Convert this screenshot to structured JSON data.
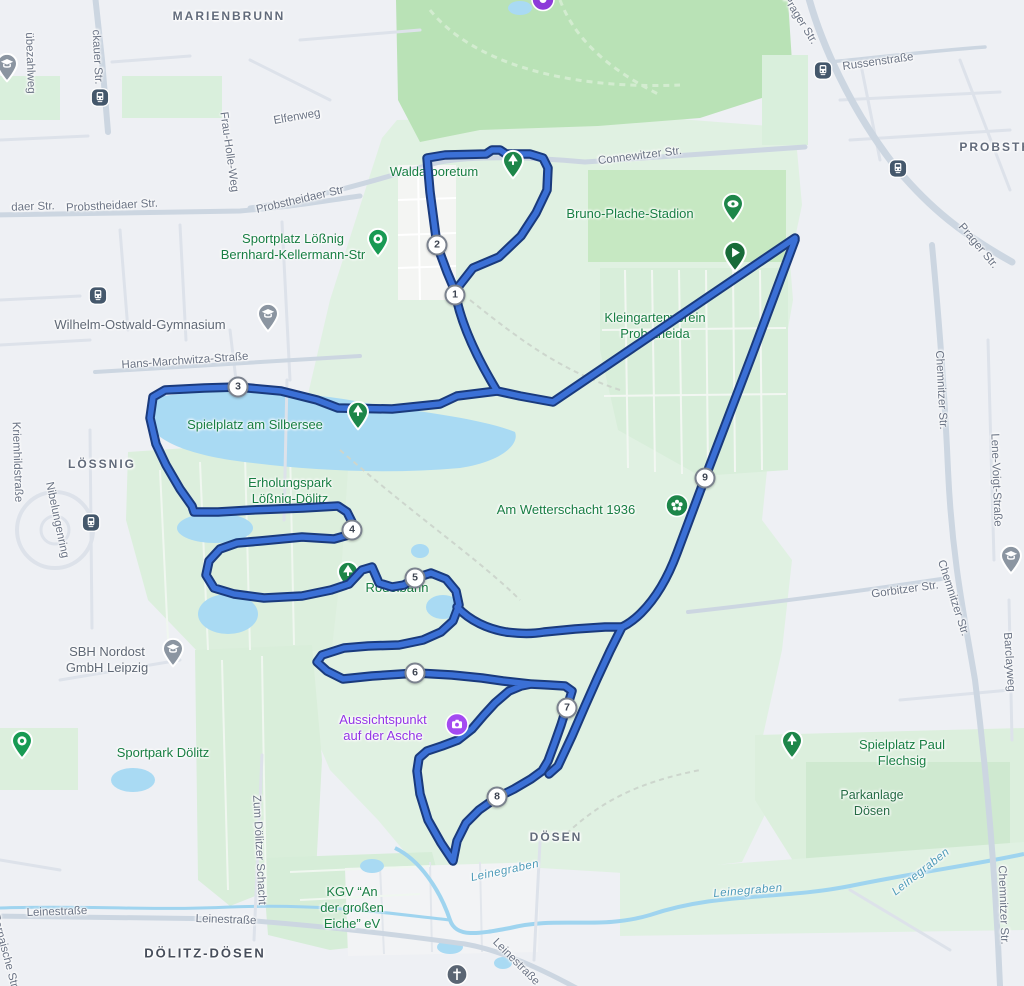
{
  "map": {
    "route": {
      "fill_color": "#3b70d6",
      "outline_color": "#1a3a7c",
      "start_color": "#186b38",
      "km_markers": [
        {
          "label": "1",
          "x": 455,
          "y": 295
        },
        {
          "label": "2",
          "x": 437,
          "y": 245
        },
        {
          "label": "3",
          "x": 238,
          "y": 387
        },
        {
          "label": "4",
          "x": 352,
          "y": 530
        },
        {
          "label": "5",
          "x": 415,
          "y": 578
        },
        {
          "label": "6",
          "x": 415,
          "y": 673
        },
        {
          "label": "7",
          "x": 567,
          "y": 708
        },
        {
          "label": "8",
          "x": 497,
          "y": 797
        },
        {
          "label": "9",
          "x": 705,
          "y": 478
        }
      ],
      "start_marker": {
        "x": 735,
        "y": 276
      }
    },
    "area_labels": [
      {
        "text": "MARIENBRUNN",
        "x": 229,
        "y": 16,
        "rot": 0,
        "cls": "area"
      },
      {
        "text": "PROBSTHEIDA",
        "x": 1014,
        "y": 147,
        "rot": 0,
        "cls": "area"
      },
      {
        "text": "LÖSSNIG",
        "x": 102,
        "y": 464,
        "rot": 0,
        "cls": "area"
      },
      {
        "text": "DÖSEN",
        "x": 556,
        "y": 837,
        "rot": 0,
        "cls": "area"
      },
      {
        "text": "DÖLITZ-DÖSEN",
        "x": 205,
        "y": 953,
        "rot": 0,
        "cls": "area-dark"
      }
    ],
    "street_labels": [
      {
        "text": "übezahlweg",
        "x": 30,
        "y": 63,
        "rot": 88
      },
      {
        "text": "ckauer Str.",
        "x": 97,
        "y": 57,
        "rot": 87
      },
      {
        "text": "Frau-Holle-Weg",
        "x": 229,
        "y": 152,
        "rot": 82
      },
      {
        "text": "Elfenweg",
        "x": 297,
        "y": 117,
        "rot": -10
      },
      {
        "text": "daer Str.",
        "x": 33,
        "y": 207,
        "rot": -2
      },
      {
        "text": "Probstheidaer Str.",
        "x": 112,
        "y": 206,
        "rot": -3
      },
      {
        "text": "Probstheidaer Str",
        "x": 300,
        "y": 200,
        "rot": -13
      },
      {
        "text": "Connewitzer Str.",
        "x": 640,
        "y": 156,
        "rot": -7
      },
      {
        "text": "Prager Str.",
        "x": 800,
        "y": 20,
        "rot": 58
      },
      {
        "text": "Russenstraße",
        "x": 878,
        "y": 62,
        "rot": -8
      },
      {
        "text": "Prager Str.",
        "x": 978,
        "y": 246,
        "rot": 50
      },
      {
        "text": "Chemnitzer Str.",
        "x": 941,
        "y": 390,
        "rot": 87
      },
      {
        "text": "Lene-Voigt-Straße",
        "x": 996,
        "y": 480,
        "rot": 88
      },
      {
        "text": "Chemnitzer Str.",
        "x": 953,
        "y": 598,
        "rot": 72
      },
      {
        "text": "Gorbitzer Str.",
        "x": 905,
        "y": 590,
        "rot": -8
      },
      {
        "text": "Barclayweg",
        "x": 1009,
        "y": 662,
        "rot": 86
      },
      {
        "text": "Hans-Marchwitza-Straße",
        "x": 185,
        "y": 361,
        "rot": -4
      },
      {
        "text": "Kriemhildstraße",
        "x": 17,
        "y": 462,
        "rot": 88
      },
      {
        "text": "Nibelungenring",
        "x": 57,
        "y": 520,
        "rot": 78
      },
      {
        "text": "Zum Dölitzer Schacht",
        "x": 259,
        "y": 850,
        "rot": 87
      },
      {
        "text": "Leinestraße",
        "x": 57,
        "y": 912,
        "rot": -2
      },
      {
        "text": "Leinestraße",
        "x": 226,
        "y": 920,
        "rot": 2
      },
      {
        "text": "Leinestraße",
        "x": 516,
        "y": 962,
        "rot": 45
      },
      {
        "text": "Bornaische Str.",
        "x": 5,
        "y": 952,
        "rot": 75
      },
      {
        "text": "Chemnitzer Str.",
        "x": 1003,
        "y": 905,
        "rot": 88
      }
    ],
    "water_labels": [
      {
        "text": "Leinegraben",
        "x": 505,
        "y": 871,
        "rot": -12
      },
      {
        "text": "Leinegraben",
        "x": 748,
        "y": 891,
        "rot": -5
      },
      {
        "text": "Leinegraben",
        "x": 921,
        "y": 872,
        "rot": -38
      }
    ],
    "poi_labels": [
      {
        "lines": [
          "Waldarboretum"
        ],
        "x": 434,
        "y": 172,
        "cls": "green",
        "name": "poi-waldarboretum"
      },
      {
        "lines": [
          "Bruno-Plache-Stadion"
        ],
        "x": 630,
        "y": 214,
        "cls": "green",
        "name": "poi-bruno-plache-stadion"
      },
      {
        "lines": [
          "Sportplatz Lößnig",
          "Bernhard-Kellermann-Str"
        ],
        "x": 293,
        "y": 247,
        "cls": "green",
        "name": "poi-sportplatz-loessnig"
      },
      {
        "lines": [
          "Wilhelm-Ostwald-Gymnasium"
        ],
        "x": 140,
        "y": 325,
        "cls": "gray",
        "name": "poi-wilhelm-ostwald-gymnasium"
      },
      {
        "lines": [
          "Kleingartenverein",
          "Probstheida"
        ],
        "x": 655,
        "y": 326,
        "cls": "green",
        "name": "poi-kleingartenverein-probstheida"
      },
      {
        "lines": [
          "Spielplatz am Silbersee"
        ],
        "x": 255,
        "y": 425,
        "cls": "green",
        "name": "poi-spielplatz-am-silbersee"
      },
      {
        "lines": [
          "Erholungspark",
          "Lößnig-Dölitz"
        ],
        "x": 290,
        "y": 491,
        "cls": "green",
        "name": "poi-erholungspark-loessnig-doelitz"
      },
      {
        "lines": [
          "Am Wetterschacht 1936"
        ],
        "x": 566,
        "y": 510,
        "cls": "green",
        "name": "poi-am-wetterschacht-1936"
      },
      {
        "lines": [
          "SBH Nordost",
          "GmbH Leipzig"
        ],
        "x": 107,
        "y": 660,
        "cls": "gray",
        "name": "poi-sbh-nordost"
      },
      {
        "lines": [
          "Sportpark Dölitz"
        ],
        "x": 163,
        "y": 753,
        "cls": "green",
        "name": "poi-sportpark-doelitz"
      },
      {
        "lines": [
          "Aussichtspunkt",
          "auf der Asche"
        ],
        "x": 383,
        "y": 728,
        "cls": "purple",
        "name": "poi-aussichtspunkt-auf-der-asche"
      },
      {
        "lines": [
          "Spielplatz Paul Flechsig"
        ],
        "x": 902,
        "y": 753,
        "cls": "green",
        "name": "poi-spielplatz-paul-flechsig"
      },
      {
        "lines": [
          "Parkanlage",
          "Dösen"
        ],
        "x": 872,
        "y": 803,
        "cls": "darkgreen",
        "name": "poi-parkanlage-doesen"
      },
      {
        "lines": [
          "KGV “An",
          "der großen",
          "Eiche” eV"
        ],
        "x": 352,
        "y": 908,
        "cls": "green",
        "name": "poi-kgv-an-der-grossen-eiche"
      }
    ],
    "under_route_poi": [
      {
        "lines": [
          "Rodelbahn"
        ],
        "x": 397,
        "y": 588,
        "cls": "green",
        "name": "poi-rodelbahn"
      }
    ],
    "pins": [
      {
        "type": "tram-station-icon",
        "x": 100,
        "y": 100
      },
      {
        "type": "tram-station-icon",
        "x": 98,
        "y": 298
      },
      {
        "type": "tram-station-icon",
        "x": 91,
        "y": 525
      },
      {
        "type": "tram-station-icon",
        "x": 823,
        "y": 73
      },
      {
        "type": "tram-station-icon",
        "x": 898,
        "y": 171
      },
      {
        "type": "school-pin-icon",
        "x": 7,
        "y": 86
      },
      {
        "type": "school-pin-icon",
        "x": 268,
        "y": 336
      },
      {
        "type": "school-pin-icon",
        "x": 173,
        "y": 671
      },
      {
        "type": "school-pin-icon",
        "x": 1011,
        "y": 578
      },
      {
        "type": "sports-pin-icon",
        "x": 378,
        "y": 261
      },
      {
        "type": "sports-pin-icon",
        "x": 22,
        "y": 763
      },
      {
        "type": "tree-pin-icon",
        "x": 513,
        "y": 183
      },
      {
        "type": "tree-pin-icon",
        "x": 358,
        "y": 434
      },
      {
        "type": "tree-pin-icon",
        "x": 792,
        "y": 763
      },
      {
        "type": "stadium-pin-icon",
        "x": 733,
        "y": 226
      },
      {
        "type": "flower-pin-icon",
        "x": 677,
        "y": 508
      },
      {
        "type": "camera-pin-icon",
        "x": 457,
        "y": 727
      },
      {
        "type": "church-icon",
        "x": 457,
        "y": 977
      },
      {
        "type": "purple-poi-icon",
        "x": 543,
        "y": 2
      }
    ],
    "under_route_pins": [
      {
        "type": "tree-pin-icon",
        "x": 348,
        "y": 594
      }
    ]
  }
}
